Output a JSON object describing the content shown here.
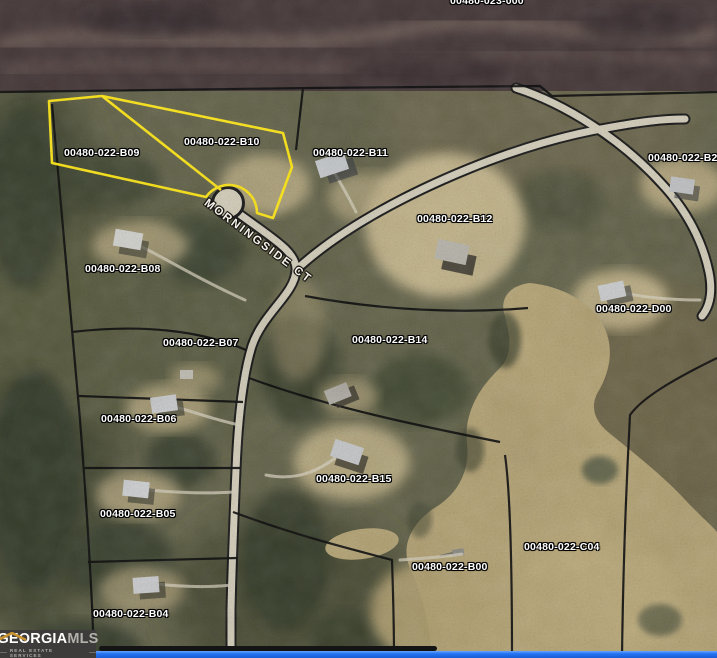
{
  "map": {
    "partial_top_parcel_id": "00480-023-000",
    "street_name": "MORNINGSIDE CT",
    "parcels": [
      {
        "id": "00480-022-B09",
        "highlighted": true
      },
      {
        "id": "00480-022-B10",
        "highlighted": true
      },
      {
        "id": "00480-022-B11",
        "highlighted": false
      },
      {
        "id": "00480-022-B12",
        "highlighted": false
      },
      {
        "id": "00480-022-B08",
        "highlighted": false
      },
      {
        "id": "00480-022-D00",
        "highlighted": false
      },
      {
        "id": "00480-022-B07",
        "highlighted": false
      },
      {
        "id": "00480-022-B14",
        "highlighted": false
      },
      {
        "id": "00480-022-B06",
        "highlighted": false
      },
      {
        "id": "00480-022-B15",
        "highlighted": false
      },
      {
        "id": "00480-022-B05",
        "highlighted": false
      },
      {
        "id": "00480-022-B04",
        "highlighted": false
      },
      {
        "id": "00480-022-B00",
        "highlighted": false
      },
      {
        "id": "00480-022-C04",
        "highlighted": false
      },
      {
        "id": "00480-022-B2",
        "highlighted": false,
        "truncated_at_right_edge": true
      }
    ]
  },
  "watermark": {
    "brand": "GEORGIA",
    "brand_suffix": "MLS",
    "tagline": "REAL ESTATE SERVICES"
  },
  "colors": {
    "highlight_outline": "#ffe81a",
    "parcel_line": "#0d0d0d",
    "label_text": "#ffffff",
    "water_tan": "#b7a678",
    "road_surface": "#d6d0bd",
    "logo_background": "#3d3c3a",
    "logo_roof_gold": "#c8922f",
    "bottom_bar_blue": "#2374f2"
  }
}
